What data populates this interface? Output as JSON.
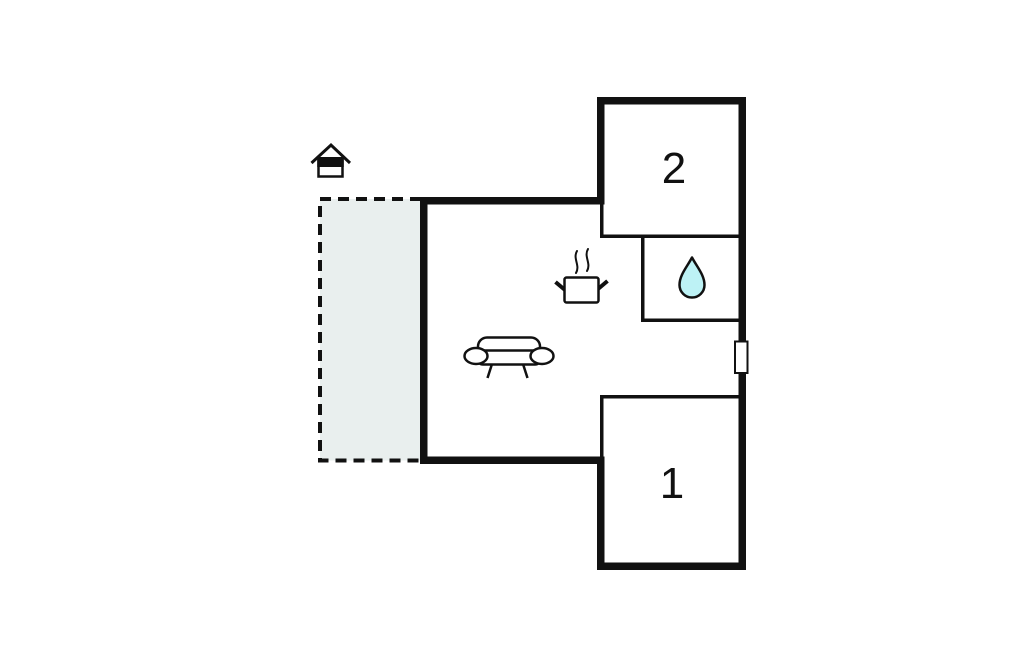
{
  "colors": {
    "page-bg": "#ffffff",
    "wall": "#111111",
    "terrace-fill": "#e9efee",
    "drop-fill": "#bdf2f5",
    "icon-white": "#ffffff"
  },
  "floorplan": {
    "type": "floor-plan",
    "rooms": [
      {
        "id": "bedroom-2",
        "label": "2"
      },
      {
        "id": "bedroom-1",
        "label": "1"
      },
      {
        "id": "bathroom",
        "label": "",
        "icon": "water-drop-icon"
      },
      {
        "id": "living-kitchen",
        "label": "",
        "icons": [
          "cooking-pot-icon",
          "sofa-icon"
        ]
      },
      {
        "id": "terrace",
        "label": "",
        "outline": "dashed"
      }
    ],
    "markers": [
      {
        "id": "house-entrance",
        "icon": "house-icon"
      },
      {
        "id": "window",
        "icon": "window-marker",
        "position": "right-wall"
      }
    ]
  }
}
